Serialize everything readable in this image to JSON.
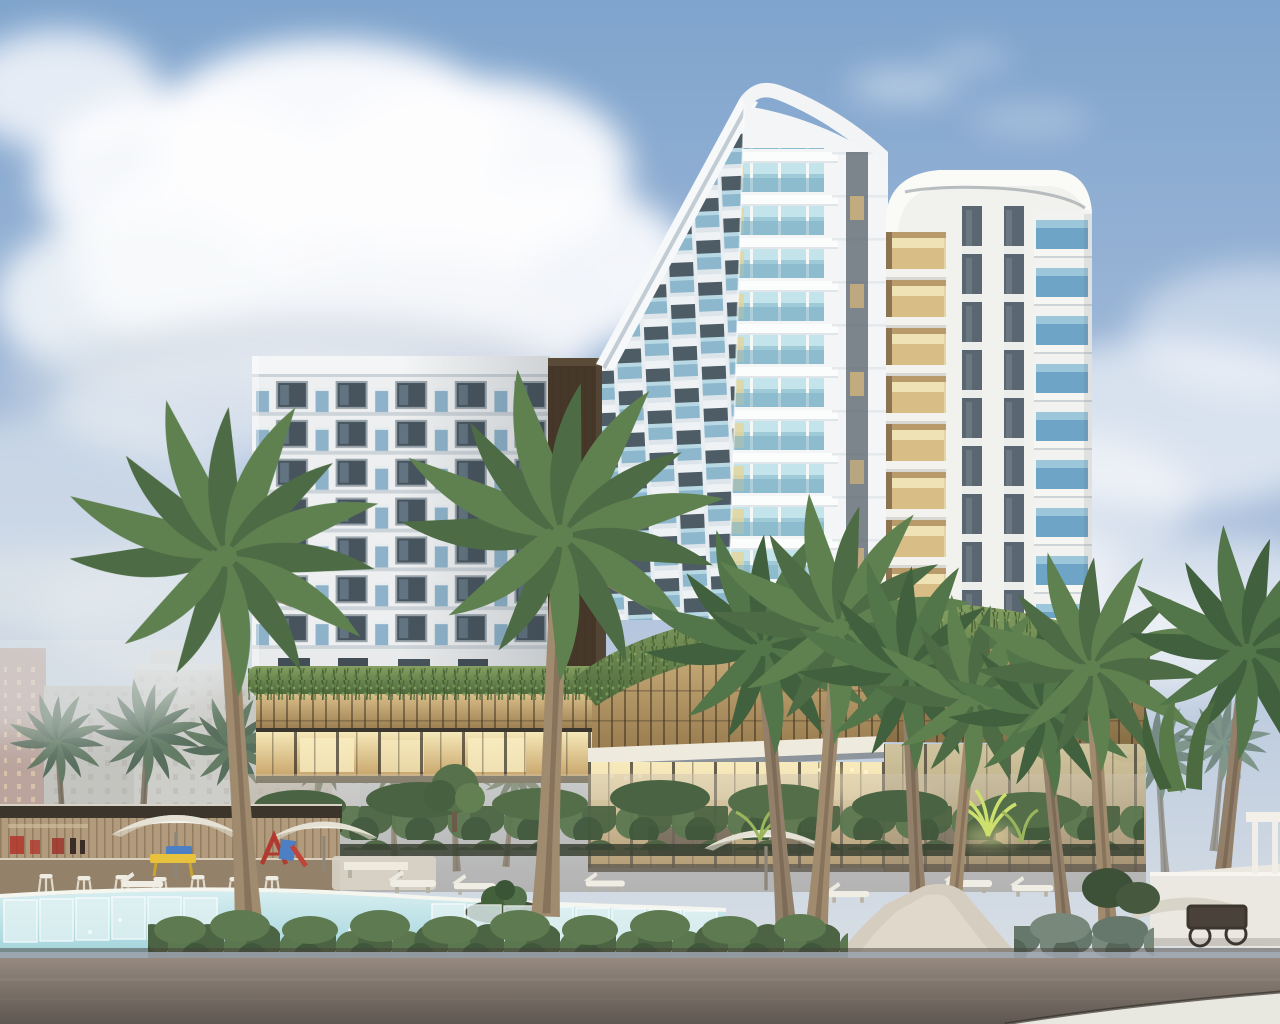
{
  "scene": {
    "type": "3d-architectural-rendering",
    "description": "Dusk rendering of a modern tropical resort hotel: three white towers with blue glass balconies rise above a two-level podium wrapped in a golden lattice screen and hanging vines, with a warm-lit glass lobby. In front are coconut palms, a free-form pool with glass edge panels, a timber pool bar with white stools, white patio umbrellas, sun loungers, a small play set, clipped hedges, a stone walkway and an asphalt street. Hazy city high-rises sit behind on the left under a partly cloudy blue sky.",
    "time_of_day": "dusk",
    "weather": "partly cloudy"
  },
  "objects": {
    "sky": "partly cloudy blue sky",
    "clouds": "soft cumulus cloud banks",
    "city_background": "hazy high-rise buildings at left",
    "left_wing": "mid-rise white hotel wing with gridded windows and blue juliet balconies",
    "timber_core": "dark timber service core with warm lit slots",
    "main_tower": "tall white tower with sloped roofline, rounded cap and staggered teal glass balconies",
    "right_tower": "white tower with rounded roof cap, golden lit recessed balconies and blue glass balconies",
    "podium": "two-level podium: golden lattice screen, vine-draped roof edge, warm-lit glass lobby",
    "pool": "free-form swimming pool with glass edge panels and white coping",
    "pool_bar": "timber pool bar with red accents and white bar stools",
    "umbrellas": "white patio umbrellas",
    "loungers": "white sun loungers",
    "playground": "small red and blue play set with yellow kids table",
    "palm_trees": "coconut palms around the pool deck",
    "lit_plants": "up-lit spiky plants",
    "hedge": "rows of round clipped shrubs",
    "walkway": "light stone walkway",
    "garden_wall": "white garden wall with stone bench and bar cart",
    "road": "asphalt street in the foreground",
    "sidewalk": "light concrete sidewalk corner"
  },
  "colors": {
    "sky_top": "#7fa4cd",
    "sky_mid": "#a9bedb",
    "sky_horizon": "#dfe3e6",
    "cloud_white": "#fdfdfe",
    "facade_white": "#edeff0",
    "tower_white": "#f3f5f6",
    "tower_shadow": "#dde5ea",
    "window_glass": "#47545e",
    "balcony_glass": "#7fa9c4",
    "teal_glass": "#9fcbd8",
    "balcony_blue_deep": "#6ea4c6",
    "window_strip": "#5a6671",
    "warm_balcony": "#d9bd86",
    "timber_core": "#453729",
    "lattice_light": "#dcc08a",
    "lattice_gold": "#9a7d50",
    "podium_glass_light": "#f6e8b8",
    "podium_glass_warm": "#c8a66c",
    "vine_light": "#85a061",
    "vine_green": "#4f6a3c",
    "palm_green": "#4d6b44",
    "palm_green_light": "#5f8150",
    "palm_trunk": "#a08b6f",
    "pool_light": "#d6eef0",
    "pool_water": "#9fd2da",
    "pool_glass": "#e2f2f3",
    "hedge_green": "#5b7750",
    "hedge_gray_green": "#78887a",
    "deck_tan": "#cec3b1",
    "road_light": "#968a80",
    "road_dark": "#5e5650",
    "curb": "#9aa2ab",
    "sidewalk": "#e9e8e0",
    "city_haze": "#c6c0b5",
    "city_red_tower": "#a5796a",
    "accent_red": "#b03a30",
    "accent_yellow": "#e8c23c",
    "accent_blue": "#4d7fc4",
    "umbrella_white": "#f4f2ea"
  }
}
